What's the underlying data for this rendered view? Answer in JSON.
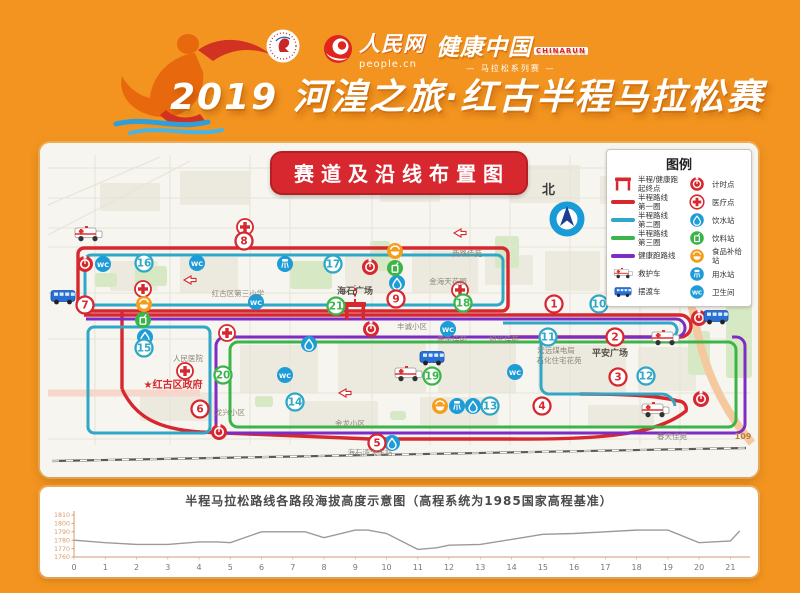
{
  "header": {
    "title": "2019 河湟之旅·红古半程马拉松赛",
    "people_logo": {
      "name": "人民网",
      "sub": "people.cn"
    },
    "health_logo": {
      "name": "健康中国",
      "tag": "CHINARUN",
      "sub": "— 马拉松系列赛 —"
    }
  },
  "map": {
    "panel_title": "赛道及沿线布置图",
    "north_label": "北",
    "colors": {
      "red": "#d7282f",
      "teal": "#2fa7c6",
      "green": "#3bb54a",
      "purple": "#7f2cc4",
      "blue": "#1e9cd7",
      "orange": "#f59e1e"
    },
    "legend": {
      "title": "图例",
      "left": [
        {
          "icon": "gate",
          "label": "半程/健康跑\n起终点"
        },
        {
          "icon": "line-red",
          "label": "半程路线\n第一圈"
        },
        {
          "icon": "line-teal",
          "label": "半程路线\n第二圈"
        },
        {
          "icon": "line-green",
          "label": "半程路线\n第三圈"
        },
        {
          "icon": "line-purple",
          "label": "健康跑路线"
        },
        {
          "icon": "ambulance",
          "label": "救护车"
        },
        {
          "icon": "bus",
          "label": "摆渡车"
        }
      ],
      "right": [
        {
          "icon": "timing",
          "label": "计时点"
        },
        {
          "icon": "medical",
          "label": "医疗点"
        },
        {
          "icon": "drop",
          "label": "饮水站"
        },
        {
          "icon": "drink",
          "label": "饮料站"
        },
        {
          "icon": "food",
          "label": "食品补给站"
        },
        {
          "icon": "spray",
          "label": "用水站"
        },
        {
          "icon": "wc",
          "label": "卫生间"
        }
      ]
    },
    "km_markers": [
      {
        "n": 1,
        "lap": 1,
        "x": 514,
        "y": 161
      },
      {
        "n": 2,
        "lap": 1,
        "x": 575,
        "y": 194
      },
      {
        "n": 3,
        "lap": 1,
        "x": 578,
        "y": 234
      },
      {
        "n": 4,
        "lap": 1,
        "x": 502,
        "y": 263
      },
      {
        "n": 5,
        "lap": 1,
        "x": 337,
        "y": 300
      },
      {
        "n": 6,
        "lap": 1,
        "x": 160,
        "y": 266
      },
      {
        "n": 7,
        "lap": 1,
        "x": 45,
        "y": 162
      },
      {
        "n": 8,
        "lap": 1,
        "x": 204,
        "y": 98
      },
      {
        "n": 9,
        "lap": 1,
        "x": 356,
        "y": 156
      },
      {
        "n": 10,
        "lap": 2,
        "x": 559,
        "y": 161
      },
      {
        "n": 11,
        "lap": 2,
        "x": 508,
        "y": 194
      },
      {
        "n": 12,
        "lap": 2,
        "x": 606,
        "y": 233
      },
      {
        "n": 13,
        "lap": 2,
        "x": 450,
        "y": 263
      },
      {
        "n": 14,
        "lap": 2,
        "x": 255,
        "y": 259
      },
      {
        "n": 15,
        "lap": 2,
        "x": 104,
        "y": 205
      },
      {
        "n": 16,
        "lap": 2,
        "x": 104,
        "y": 120
      },
      {
        "n": 17,
        "lap": 2,
        "x": 293,
        "y": 121
      },
      {
        "n": 18,
        "lap": 3,
        "x": 423,
        "y": 160
      },
      {
        "n": 19,
        "lap": 3,
        "x": 392,
        "y": 233
      },
      {
        "n": 20,
        "lap": 3,
        "x": 183,
        "y": 232
      },
      {
        "n": 21,
        "lap": 3,
        "x": 296,
        "y": 163
      }
    ],
    "icons": [
      {
        "t": "timing",
        "x": 45,
        "y": 121
      },
      {
        "t": "wc",
        "x": 63,
        "y": 121
      },
      {
        "t": "timing",
        "x": 330,
        "y": 124
      },
      {
        "t": "timing",
        "x": 331,
        "y": 186
      },
      {
        "t": "timing",
        "x": 659,
        "y": 175
      },
      {
        "t": "timing",
        "x": 661,
        "y": 256
      },
      {
        "t": "timing",
        "x": 179,
        "y": 289
      },
      {
        "t": "wc",
        "x": 157,
        "y": 120
      },
      {
        "t": "wc",
        "x": 216,
        "y": 159
      },
      {
        "t": "wc",
        "x": 245,
        "y": 232
      },
      {
        "t": "wc",
        "x": 408,
        "y": 186
      },
      {
        "t": "wc",
        "x": 475,
        "y": 229
      },
      {
        "t": "medical",
        "x": 205,
        "y": 84
      },
      {
        "t": "medical",
        "x": 103,
        "y": 146
      },
      {
        "t": "medical",
        "x": 420,
        "y": 147
      },
      {
        "t": "medical",
        "x": 187,
        "y": 190
      },
      {
        "t": "medical",
        "x": 145,
        "y": 228
      },
      {
        "t": "drop",
        "x": 105,
        "y": 194
      },
      {
        "t": "drop",
        "x": 357,
        "y": 140
      },
      {
        "t": "drop",
        "x": 269,
        "y": 201
      },
      {
        "t": "drop",
        "x": 352,
        "y": 300
      },
      {
        "t": "drop",
        "x": 433,
        "y": 263
      },
      {
        "t": "food",
        "x": 104,
        "y": 161
      },
      {
        "t": "food",
        "x": 355,
        "y": 108
      },
      {
        "t": "food",
        "x": 400,
        "y": 263
      },
      {
        "t": "drink",
        "x": 103,
        "y": 177
      },
      {
        "t": "drink",
        "x": 355,
        "y": 125
      },
      {
        "t": "spray",
        "x": 245,
        "y": 121
      },
      {
        "t": "spray",
        "x": 417,
        "y": 263
      },
      {
        "t": "gate",
        "x": 315,
        "y": 168
      },
      {
        "t": "ambulance",
        "x": 48,
        "y": 92
      },
      {
        "t": "ambulance",
        "x": 368,
        "y": 232
      },
      {
        "t": "ambulance",
        "x": 625,
        "y": 196
      },
      {
        "t": "ambulance",
        "x": 615,
        "y": 268
      },
      {
        "t": "bus",
        "x": 23,
        "y": 154
      },
      {
        "t": "bus",
        "x": 676,
        "y": 174
      },
      {
        "t": "bus",
        "x": 392,
        "y": 215
      },
      {
        "t": "arrow",
        "x": 150,
        "y": 137
      },
      {
        "t": "arrow",
        "x": 420,
        "y": 90
      },
      {
        "t": "arrow",
        "x": 305,
        "y": 250
      },
      {
        "t": "arrow",
        "x": 585,
        "y": 93
      }
    ],
    "labels": [
      {
        "text": "海石广场",
        "x": 315,
        "y": 151,
        "c": "place"
      },
      {
        "text": "★红古区政府",
        "x": 133,
        "y": 245,
        "c": "gov"
      },
      {
        "text": "平安广场",
        "x": 570,
        "y": 213,
        "c": "place"
      },
      {
        "text": "金海天花园",
        "x": 408,
        "y": 141,
        "c": "small"
      },
      {
        "text": "丰诚小区",
        "x": 372,
        "y": 186,
        "c": "small"
      },
      {
        "text": "康乐佳苑",
        "x": 412,
        "y": 199,
        "c": "small"
      },
      {
        "text": "旭光佳苑",
        "x": 464,
        "y": 199,
        "c": "small"
      },
      {
        "text": "宏远煤电局",
        "x": 516,
        "y": 210,
        "c": "small"
      },
      {
        "text": "石化住宅花苑",
        "x": 519,
        "y": 220,
        "c": "small"
      },
      {
        "text": "龙兴小区",
        "x": 190,
        "y": 272,
        "c": "small"
      },
      {
        "text": "金龙小区",
        "x": 310,
        "y": 283,
        "c": "small"
      },
      {
        "text": "春天佳苑",
        "x": 632,
        "y": 296,
        "c": "small"
      },
      {
        "text": "海石湾大车站",
        "x": 330,
        "y": 312,
        "c": "small"
      },
      {
        "text": "红古区第三小学",
        "x": 198,
        "y": 153,
        "c": "small"
      },
      {
        "text": "西路佳苑",
        "x": 427,
        "y": 113,
        "c": "small"
      },
      {
        "text": "人民医院",
        "x": 148,
        "y": 218,
        "c": "small"
      },
      {
        "text": "109",
        "x": 703,
        "y": 296,
        "c": "road"
      }
    ]
  },
  "chart_data": {
    "type": "line",
    "title": "半程马拉松路线各路段海拔高度示意图（高程系统为1985国家高程基准）",
    "xlabel": "",
    "ylabel": "",
    "x": [
      0,
      1,
      2,
      3,
      4,
      4.6,
      5,
      6,
      7,
      7.4,
      8,
      9,
      9.4,
      10,
      11,
      11.6,
      12,
      13,
      14,
      15,
      16,
      17,
      18,
      19,
      20,
      21,
      21.3
    ],
    "y": [
      1780,
      1777,
      1775,
      1775,
      1778,
      1778,
      1777,
      1790,
      1790,
      1790,
      1783,
      1792,
      1792,
      1788,
      1769,
      1771,
      1774,
      1775,
      1781,
      1787,
      1788,
      1790,
      1792,
      1792,
      1777,
      1779,
      1791
    ],
    "ylim": [
      1760,
      1810
    ],
    "yticks": [
      1760,
      1770,
      1780,
      1790,
      1800,
      1810
    ],
    "xticks": [
      0,
      1,
      2,
      3,
      4,
      5,
      6,
      7,
      8,
      9,
      10,
      11,
      12,
      13,
      14,
      15,
      16,
      17,
      18,
      19,
      20,
      21
    ],
    "line_color": "#9a9a9a",
    "axis_color": "#d89a6a",
    "grid": false,
    "legend_position": "none"
  }
}
